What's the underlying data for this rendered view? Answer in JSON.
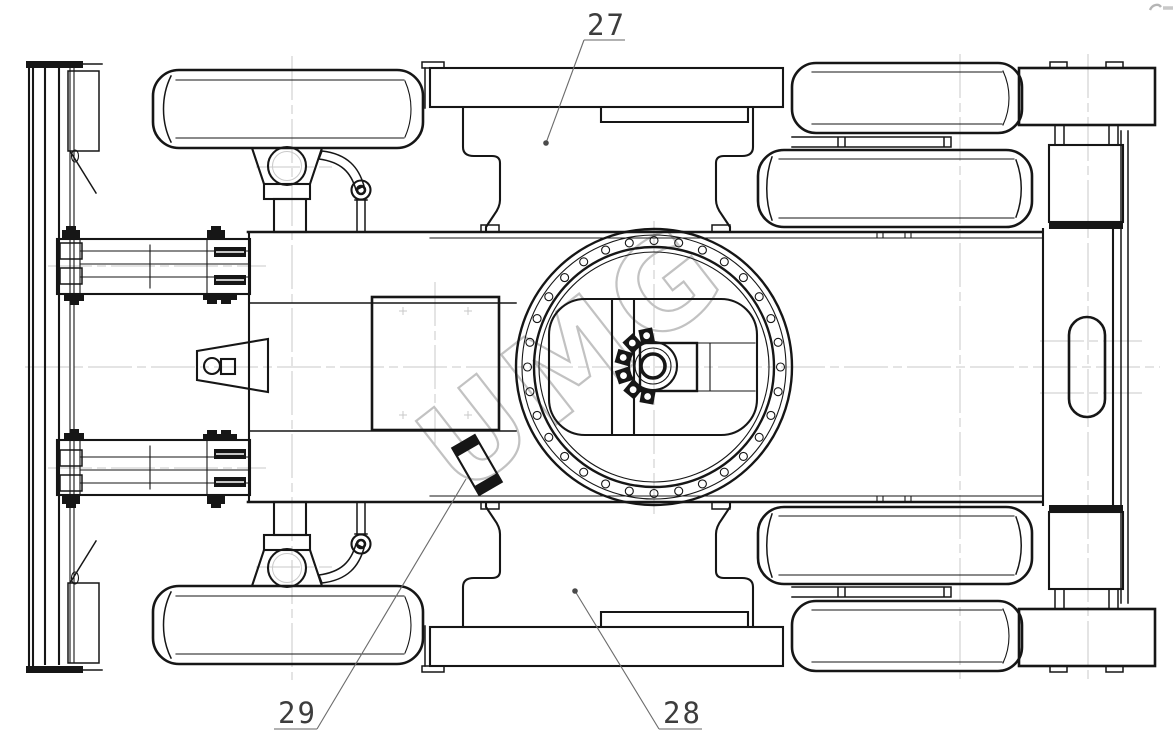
{
  "watermark": {
    "text": "UMG"
  },
  "callouts": {
    "c27": "27",
    "c28": "28",
    "c29": "29"
  },
  "colors": {
    "line": "#161616",
    "centerline": "#c9c9c9",
    "watermark": "#c2c2c2",
    "label": "#3d3d3d",
    "leader": "#6b6b6b",
    "hatch": "#c6c6c6",
    "paper": "#ffffff"
  }
}
